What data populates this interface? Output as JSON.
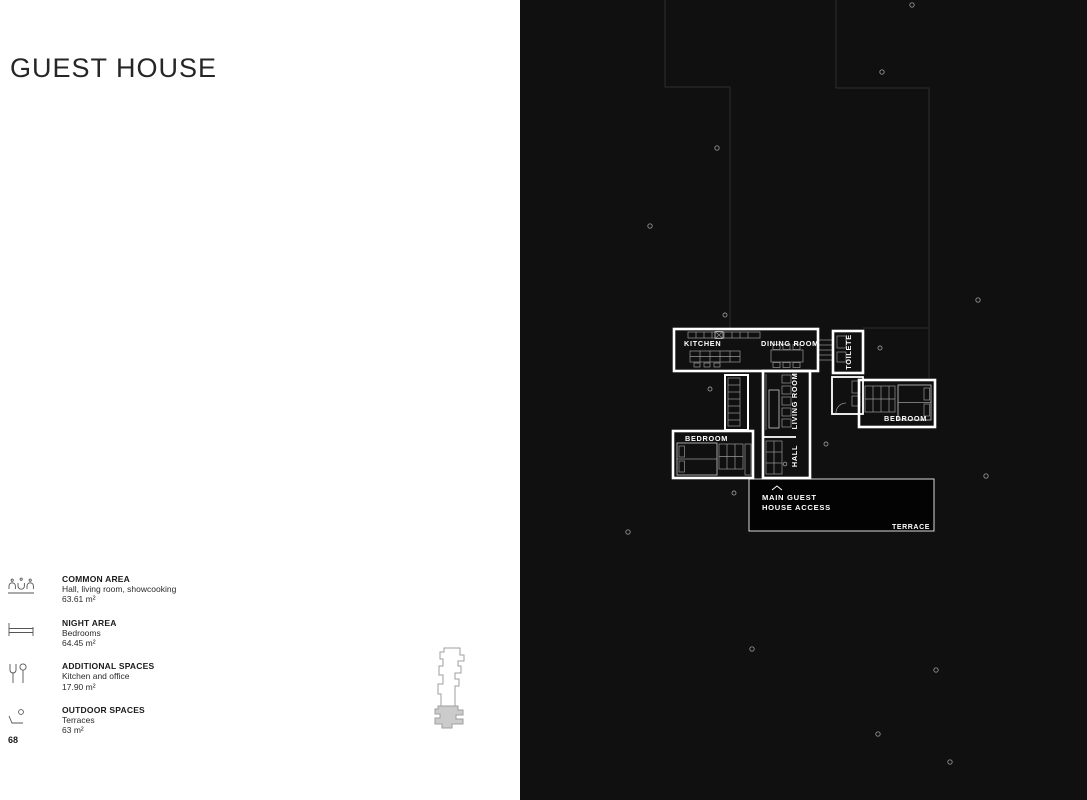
{
  "page": {
    "title": "GUEST HOUSE",
    "page_number": "68"
  },
  "legend": {
    "items": [
      {
        "icon": "people-at-table-icon",
        "label": "COMMON AREA",
        "description": "Hall, living room, showcooking",
        "area": "63.61 m²"
      },
      {
        "icon": "bed-icon",
        "label": "NIGHT AREA",
        "description": "Bedrooms",
        "area": "64.45 m²"
      },
      {
        "icon": "cutlery-icon",
        "label": "ADDITIONAL SPACES",
        "description": "Kitchen and office",
        "area": "17.90 m²"
      },
      {
        "icon": "terrace-lounger-icon",
        "label": "OUTDOOR SPACES",
        "description": "Terraces",
        "area": "63 m²"
      }
    ]
  },
  "floorplan": {
    "rooms": {
      "kitchen": "KITCHEN",
      "dining_room": "DINING ROOM",
      "toilete": "TOILETE",
      "living_room": "LIVING ROOM",
      "hall": "HALL",
      "bedroom_left": "BEDROOM",
      "bedroom_right": "BEDROOM"
    },
    "access_line1": "MAIN GUEST",
    "access_line2": "HOUSE ACCESS",
    "terrace": "TERRACE"
  },
  "colors": {
    "left_page_bg": "#ffffff",
    "right_page_bg": "#101010",
    "plan_wall": "#ffffff",
    "site_boundary_line": "#2e2e2e",
    "title_text": "#262626",
    "access_panel_bg": "#030303",
    "miniplan_fill": "#cbcbcb"
  }
}
